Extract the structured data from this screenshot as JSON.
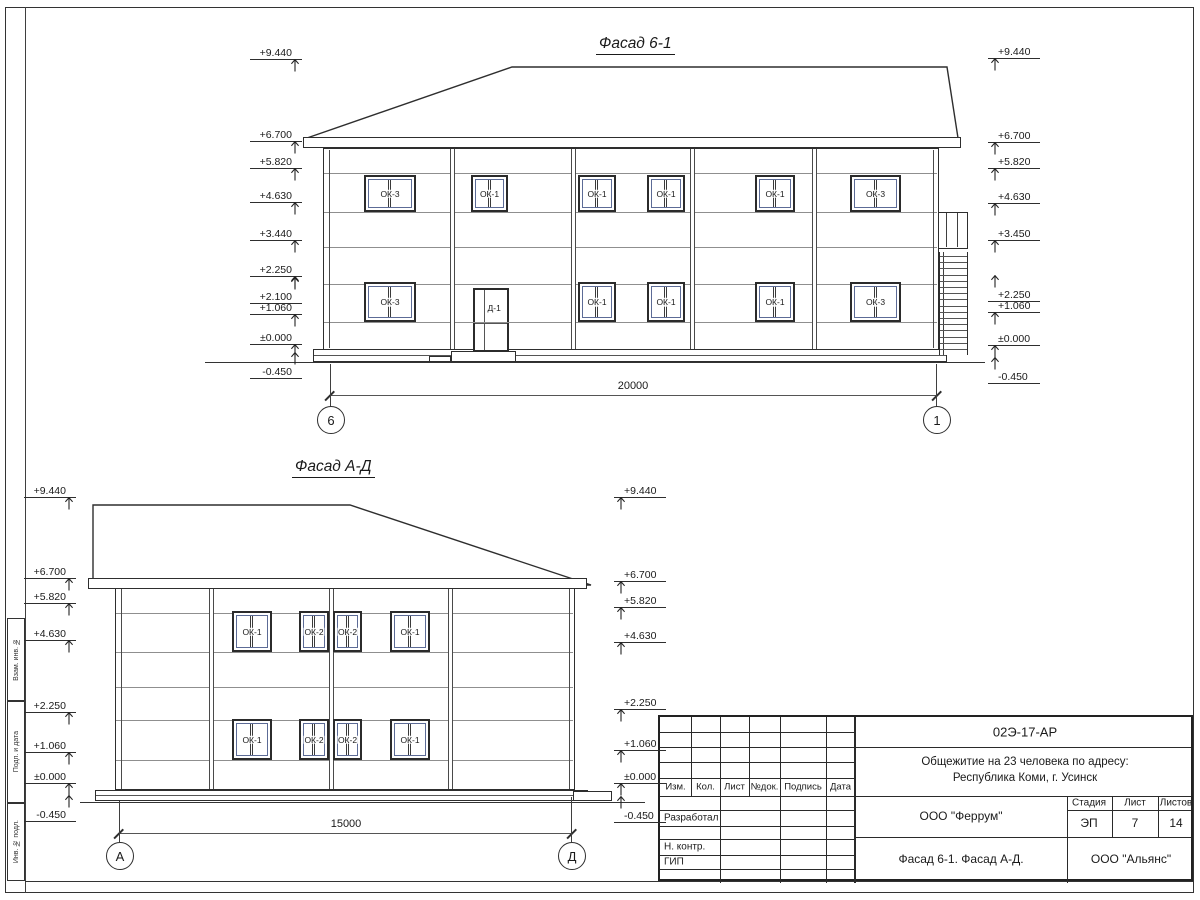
{
  "sheet": {
    "frame_margin_labels": [
      "Взам. инв. №",
      "Подп. и дата",
      "Инв. № подл."
    ]
  },
  "facade1": {
    "title": "Фасад 6-1",
    "marks_left": [
      "+9.440",
      "+6.700",
      "+5.820",
      "+4.630",
      "+3.440",
      "+2.250",
      "+2.100",
      "+1.060",
      "±0.000",
      "-0.450"
    ],
    "marks_right": [
      "+9.440",
      "+6.700",
      "+5.820",
      "+4.630",
      "+3.450",
      "+2.250",
      "+1.060",
      "±0.000",
      "-0.450"
    ],
    "windows_upper": [
      "ОК-3",
      "ОК-1",
      "ОК-1",
      "ОК-1",
      "ОК-1",
      "ОК-3"
    ],
    "windows_lower": [
      "ОК-3",
      "ОК-1",
      "ОК-1",
      "ОК-1",
      "ОК-3"
    ],
    "door_label": "Д-1",
    "dimension": "20000",
    "axis_left": "6",
    "axis_right": "1"
  },
  "facade2": {
    "title": "Фасад А-Д",
    "marks_left": [
      "+9.440",
      "+6.700",
      "+5.820",
      "+4.630",
      "+2.250",
      "+1.060",
      "±0.000",
      "-0.450"
    ],
    "marks_right": [
      "+9.440",
      "+6.700",
      "+5.820",
      "+4.630",
      "+2.250",
      "+1.060",
      "±0.000",
      "-0.450"
    ],
    "windows_upper": [
      "ОК-1",
      "ОК-2",
      "ОК-2",
      "ОК-1"
    ],
    "windows_lower": [
      "ОК-1",
      "ОК-2",
      "ОК-2",
      "ОК-1"
    ],
    "dimension": "15000",
    "axis_left": "А",
    "axis_right": "Д"
  },
  "titleblock": {
    "doc_code": "02Э-17-АР",
    "project_line1": "Общежитие на 23 человека по адресу:",
    "project_line2": "Республика Коми, г. Усинск",
    "org_design": "ООО \"Феррум\"",
    "sheet_name": "Фасад 6-1. Фасад  А-Д.",
    "org_contractor": "ООО \"Альянс\"",
    "stage_label": "Стадия",
    "stage_value": "ЭП",
    "sheet_label": "Лист",
    "sheet_value": "7",
    "sheets_label": "Листов",
    "sheets_value": "14",
    "header_cols": [
      "Изм.",
      "Кол.",
      "Лист",
      "№док.",
      "Подпись",
      "Дата"
    ],
    "role_rows": [
      "Разработал",
      "Н. контр.",
      "ГИП"
    ]
  }
}
